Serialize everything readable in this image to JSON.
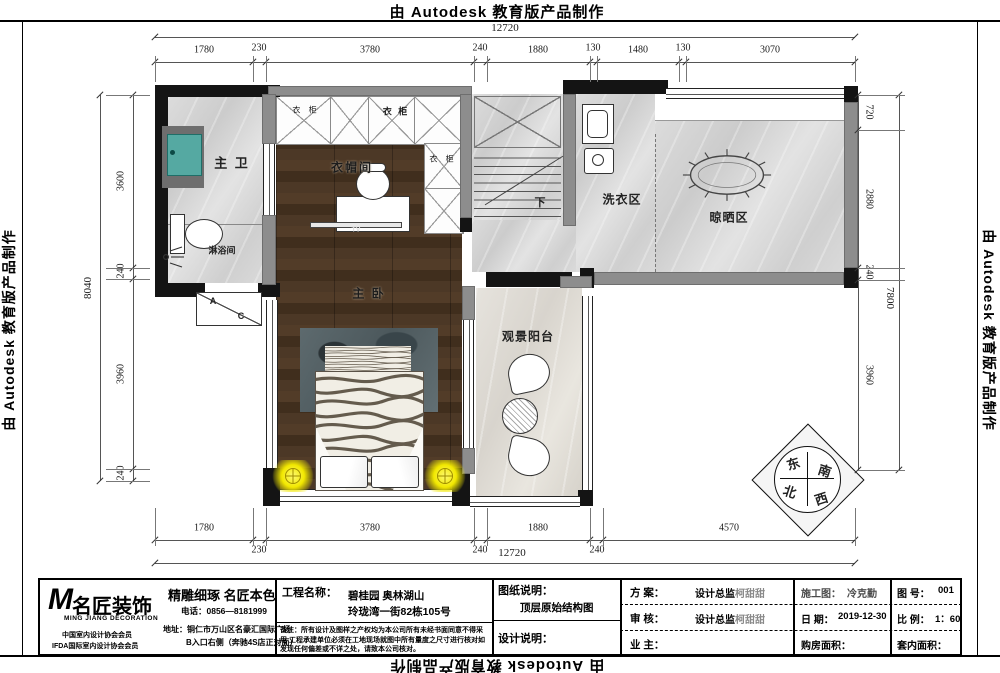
{
  "watermark": "由 Autodesk 教育版产品制作",
  "plan": {
    "rooms": {
      "master_bath": "主 卫",
      "shower": "淋浴间",
      "closet": "衣帽间",
      "wardrobe1": "衣 柜",
      "wardrobe2": "衣 柜",
      "wardrobe_right": "衣 柜",
      "tv": "TV",
      "stairs_down": "下",
      "laundry": "洗衣区",
      "drying": "晾晒区",
      "bedroom": "主 卧",
      "balcony": "观景阳台",
      "ac_a": "A",
      "ac_c": "C"
    },
    "compass": {
      "e": "东",
      "s": "南",
      "n": "北",
      "w": "西"
    }
  },
  "dims": {
    "top_total": "12720",
    "bottom_total": "12720",
    "left_total": "8040",
    "right_total": "7800",
    "top": [
      "1780",
      "230",
      "3780",
      "240",
      "1880",
      "130",
      "1480",
      "130",
      "3070"
    ],
    "bottom": [
      "1780",
      "230",
      "3780",
      "240",
      "1880",
      "240",
      "4570"
    ],
    "left": [
      "3600",
      "240",
      "3960",
      "240"
    ],
    "right": [
      "720",
      "2880",
      "240",
      "3960"
    ]
  },
  "titleblock": {
    "logo_m": "M",
    "logo_name": "名匠装饰",
    "logo_sub": "MING JIANG DECORATION",
    "member1": "中国室内设计协会会员",
    "member2": "IFDA国际室内设计协会会员",
    "slogan": "精雕细琢  名匠本色",
    "phone": "电话：0856—8181999",
    "address1": "地址：铜仁市万山区名豪汇国际广场",
    "address2": "B入口右侧（奔驰4S店正对面）",
    "project_label": "工程名称：",
    "project_line1": "碧桂园  奥林湖山",
    "project_line2": "玲珑湾一街82栋105号",
    "note": "备注：所有设计及图样之产权均为本公司所有未经书面同意不得采用 工程承建单位必须在工地现场就图中所有量度之尺寸进行核对如发现任何偏差或不详之处，请致本公司核对。",
    "drawing_label": "图纸说明：",
    "drawing_value": "顶层原始结构图",
    "design_label": "设计说明：",
    "plan_label": "方 案：",
    "plan_value_strong": "设计总监",
    "plan_value_light": "柯甜甜",
    "review_label": "审 核：",
    "review_value_strong": "设计总监",
    "review_value_light": "柯甜甜",
    "owner_label": "业 主：",
    "construction_label": "施工图：",
    "construction_value": "冷克勤",
    "date_label": "日  期：",
    "date_value": "2019-12-30",
    "area_label": "购房面积：",
    "fig_label": "图 号：",
    "fig_value": "001",
    "scale_label": "比 例：",
    "scale_value": "1：60",
    "inner_area_label": "套内面积："
  }
}
